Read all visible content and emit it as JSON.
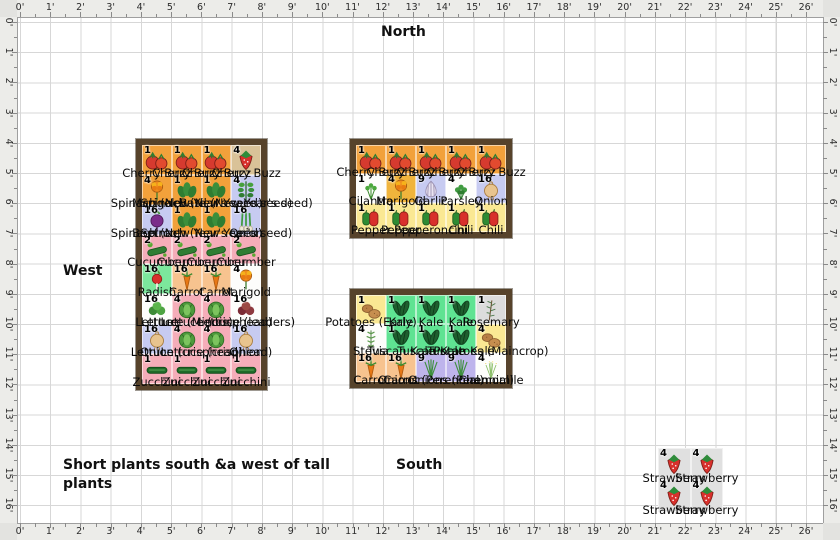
{
  "compass": {
    "north": "North",
    "west": "West",
    "south": "South"
  },
  "note": {
    "text": "Short plants south &a west of tall plants"
  },
  "rulers": {
    "top": [
      "0'",
      "1'",
      "2'",
      "3'",
      "4'",
      "5'",
      "6'",
      "7'",
      "8'",
      "9'",
      "10'",
      "11'",
      "12'",
      "13'",
      "14'",
      "15'",
      "16'",
      "17'",
      "18'",
      "19'",
      "20'",
      "21'",
      "22'",
      "23'",
      "24'",
      "25'",
      "26'"
    ],
    "bottom": [
      "0'",
      "1'",
      "2'",
      "3'",
      "4'",
      "5'",
      "6'",
      "7'",
      "8'",
      "9'",
      "10'",
      "11'",
      "12'",
      "13'",
      "14'",
      "15'",
      "16'",
      "17'",
      "18'",
      "19'",
      "20'",
      "21'",
      "22'",
      "23'",
      "24'",
      "25'",
      "26'"
    ],
    "left": [
      "0'",
      "1'",
      "2'",
      "3'",
      "4'",
      "5'",
      "6'",
      "7'",
      "8'",
      "9'",
      "10'",
      "11'",
      "12'",
      "13'",
      "14'",
      "15'",
      "16'"
    ],
    "right": [
      "0'",
      "1'",
      "2'",
      "3'",
      "4'",
      "5'",
      "6'",
      "7'",
      "8'",
      "9'",
      "10'",
      "11'",
      "12'",
      "13'",
      "14'",
      "15'",
      "16'"
    ]
  },
  "palette": {
    "orange": "#F2A13B",
    "lavender": "#C7CBF1",
    "pink": "#F5ADB9",
    "green": "#7CE79C",
    "kgreen": "#5FE392",
    "peach": "#F7C38F",
    "gold": "#F0B43C",
    "yellow": "#FAE893",
    "white": "#FDFDFB",
    "gray": "#DCDCDC",
    "tan": "#D9C298",
    "purple": "#BEB4EC",
    "patch": "#E0E0E0"
  },
  "beds": [
    {
      "name": "west-bed",
      "x": 136,
      "y": 139,
      "cw": 29.75,
      "ch": 29.85,
      "frame": 6,
      "rows": [
        [
          {
            "i": "tomato",
            "n": "1",
            "bg": "orange",
            "t": "Cherry Buzz"
          },
          {
            "i": "tomato",
            "n": "1",
            "bg": "orange",
            "t": "Cherry Buzz"
          },
          {
            "i": "tomato",
            "n": "1",
            "bg": "orange",
            "t": "Cherry Buzz"
          },
          {
            "i": "strawberry",
            "n": "4",
            "bg": "tan",
            "t": "Cherry Buzz"
          }
        ],
        [
          {
            "i": "marigold",
            "n": "4",
            "bg": "orange",
            "t": "Marigold"
          },
          {
            "i": "spinach",
            "n": "1",
            "bg": "orange",
            "t": "Spinach (New Year's seed)"
          },
          {
            "i": "spinach",
            "n": "1",
            "bg": "orange",
            "t": "Spinach (New Year's seed)"
          },
          {
            "i": "basil",
            "n": "4",
            "bg": "lavender",
            "t": "Basil (New Year's seed)"
          }
        ],
        [
          {
            "i": "beet",
            "n": "16",
            "bg": "lavender",
            "t": "Beetroot"
          },
          {
            "i": "spinach",
            "n": "1",
            "bg": "orange",
            "t": "Spinach (New Year's seed)"
          },
          {
            "i": "spinach",
            "n": "1",
            "bg": "orange",
            "t": "Spinach (New Year's seed)"
          },
          {
            "i": "scallion",
            "n": "16",
            "bg": "lavender",
            "t": "Onion"
          }
        ],
        [
          {
            "i": "cucumber",
            "n": "2",
            "bg": "pink",
            "t": "Cucumber"
          },
          {
            "i": "cucumber",
            "n": "2",
            "bg": "pink",
            "t": "Cucumber"
          },
          {
            "i": "cucumber",
            "n": "2",
            "bg": "pink",
            "t": "Cucumber"
          },
          {
            "i": "cucumber",
            "n": "2",
            "bg": "pink",
            "t": "Cucumber"
          }
        ],
        [
          {
            "i": "radish",
            "n": "16",
            "bg": "green",
            "t": "Radish"
          },
          {
            "i": "carrot",
            "n": "16",
            "bg": "peach",
            "t": "Carrot"
          },
          {
            "i": "carrot",
            "n": "16",
            "bg": "peach",
            "t": "Carrot"
          },
          {
            "i": "marigold",
            "n": "4",
            "bg": "white",
            "t": "Marigold"
          }
        ],
        [
          {
            "i": "lettuce",
            "n": "16",
            "bg": "white",
            "t": "Lettuce"
          },
          {
            "i": "lettuce_head",
            "n": "4",
            "bg": "pink",
            "t": "Lettuce (Minois)"
          },
          {
            "i": "lettuce_head",
            "n": "4",
            "bg": "pink",
            "t": "Lettuce (crisphead)"
          },
          {
            "i": "lettuce_red",
            "n": "16",
            "bg": "white",
            "t": "Lettuce (leaders)"
          }
        ],
        [
          {
            "i": "onion",
            "n": "16",
            "bg": "lavender",
            "t": "Onion"
          },
          {
            "i": "lettuce_head",
            "n": "4",
            "bg": "pink",
            "t": "Lettuce (crisphead)"
          },
          {
            "i": "lettuce_head",
            "n": "4",
            "bg": "pink",
            "t": "Lettuce (crisphead)"
          },
          {
            "i": "onion",
            "n": "16",
            "bg": "lavender",
            "t": "Onion"
          }
        ],
        [
          {
            "i": "zucchini",
            "n": "1",
            "bg": "pink",
            "t": "Zucchini"
          },
          {
            "i": "zucchini",
            "n": "1",
            "bg": "pink",
            "t": "Zucchini"
          },
          {
            "i": "zucchini",
            "n": "1",
            "bg": "pink",
            "t": "Zucchini"
          },
          {
            "i": "zucchini",
            "n": "1",
            "bg": "pink",
            "t": "Zucchini"
          }
        ]
      ]
    },
    {
      "name": "north-bed",
      "x": 350,
      "y": 139,
      "cw": 30,
      "ch": 29,
      "frame": 6,
      "rows": [
        [
          {
            "i": "tomato",
            "n": "1",
            "bg": "orange",
            "t": "Cherry Buzz"
          },
          {
            "i": "tomato",
            "n": "1",
            "bg": "orange",
            "t": "Cherry Buzz"
          },
          {
            "i": "tomato",
            "n": "1",
            "bg": "orange",
            "t": "Cherry Buzz"
          },
          {
            "i": "tomato",
            "n": "1",
            "bg": "orange",
            "t": "Cherry Buzz"
          },
          {
            "i": "tomato",
            "n": "1",
            "bg": "orange",
            "t": "Cherry Buzz"
          }
        ],
        [
          {
            "i": "cilantro",
            "n": "1",
            "bg": "white",
            "t": "Cilantro"
          },
          {
            "i": "marigold",
            "n": "4",
            "bg": "gold",
            "t": "Marigold"
          },
          {
            "i": "garlic",
            "n": "9",
            "bg": "lavender",
            "t": "Garlic"
          },
          {
            "i": "parsley",
            "n": "4",
            "bg": "white",
            "t": "Parsley"
          },
          {
            "i": "onion",
            "n": "16",
            "bg": "lavender",
            "t": "Onion"
          }
        ],
        [
          {
            "i": "pepper",
            "n": "1",
            "bg": "yellow",
            "t": "Pepper"
          },
          {
            "i": "pepper",
            "n": "1",
            "bg": "yellow",
            "t": "Pepper"
          },
          {
            "i": "pepper",
            "n": "1",
            "bg": "yellow",
            "t": "Pepperoncini"
          },
          {
            "i": "pepper",
            "n": "1",
            "bg": "yellow",
            "t": "Chili"
          },
          {
            "i": "pepper",
            "n": "1",
            "bg": "yellow",
            "t": "Chili"
          }
        ]
      ]
    },
    {
      "name": "south-bed",
      "x": 350,
      "y": 289,
      "cw": 30,
      "ch": 29,
      "frame": 6,
      "rows": [
        [
          {
            "i": "potato",
            "n": "1",
            "bg": "yellow",
            "t": "Potatoes (Early)"
          },
          {
            "i": "kale",
            "n": "1",
            "bg": "kgreen",
            "t": "Kale"
          },
          {
            "i": "kale",
            "n": "1",
            "bg": "kgreen",
            "t": "Kale"
          },
          {
            "i": "kale",
            "n": "1",
            "bg": "kgreen",
            "t": "Kale"
          },
          {
            "i": "rosemary",
            "n": "1",
            "bg": "gray",
            "t": "Rosemary"
          }
        ],
        [
          {
            "i": "stevia",
            "n": "4",
            "bg": "white",
            "t": "Stevia"
          },
          {
            "i": "kale",
            "n": "1",
            "bg": "kgreen",
            "t": "Tuscan Kale"
          },
          {
            "i": "kale",
            "n": "1",
            "bg": "kgreen",
            "t": "Tuscan Kale"
          },
          {
            "i": "kale",
            "n": "1",
            "bg": "kgreen",
            "t": "Tuscan Kale"
          },
          {
            "i": "potato",
            "n": "4",
            "bg": "yellow",
            "t": "Potatoes (Maincrop)"
          }
        ],
        [
          {
            "i": "carrot",
            "n": "16",
            "bg": "peach",
            "t": "Carrot"
          },
          {
            "i": "carrot",
            "n": "16",
            "bg": "peach",
            "t": "Carrot"
          },
          {
            "i": "chives",
            "n": "9",
            "bg": "purple",
            "t": "Onions (Perennial)"
          },
          {
            "i": "chives",
            "n": "9",
            "bg": "purple",
            "t": "Onions (Perennial)"
          },
          {
            "i": "chamomile",
            "n": "4",
            "bg": "white",
            "t": "Chamomile"
          }
        ]
      ]
    },
    {
      "name": "strawberry-patch",
      "x": 658,
      "y": 448,
      "cw": 32.5,
      "ch": 32,
      "frame": 0,
      "rows": [
        [
          {
            "i": "strawberry",
            "n": "4",
            "bg": "patch",
            "t": "Strawberry"
          },
          {
            "i": "strawberry",
            "n": "4",
            "bg": "patch",
            "t": "Strawberry"
          }
        ],
        [
          {
            "i": "strawberry",
            "n": "4",
            "bg": "patch",
            "t": "Strawberry"
          },
          {
            "i": "strawberry",
            "n": "4",
            "bg": "patch",
            "t": "Strawberry"
          }
        ]
      ]
    }
  ]
}
